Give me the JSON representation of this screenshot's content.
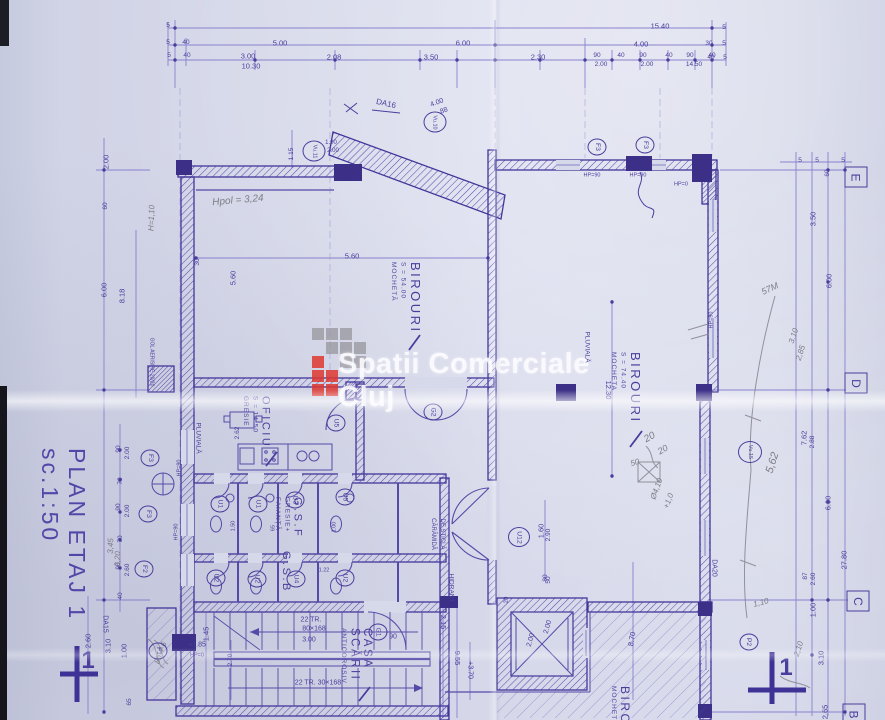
{
  "title": "PLAN ETAJ 1 sc.1:50",
  "watermark": {
    "text": "Spatii Comerciale Cluj",
    "logo_gray": "#97969c",
    "logo_red": "#dd372f"
  },
  "colors": {
    "ink": "#4a3d9c",
    "wall": "#43369a",
    "pencil": "#7e7c86",
    "paper": "#d6d9ea"
  },
  "grid_axis_labels": [
    {
      "t": "E",
      "x": 856,
      "y": 177
    },
    {
      "t": "D",
      "x": 856,
      "y": 383
    },
    {
      "t": "C",
      "x": 858,
      "y": 601
    },
    {
      "t": "B",
      "x": 854,
      "y": 714
    }
  ],
  "rooms": [
    {
      "name": "BIROURI",
      "subs": [
        "S = 54.00",
        "MOCHETĂ"
      ],
      "x": 388,
      "y": 262,
      "ns": 13
    },
    {
      "name": "BIROURI",
      "subs": [
        "S = 74.40",
        "MOCHETA"
      ],
      "x": 608,
      "y": 352,
      "ns": 13
    },
    {
      "name": "OFICIU",
      "subs": [
        "S = 14.50",
        "GRESIE"
      ],
      "x": 240,
      "y": 396,
      "ns": 11
    },
    {
      "name": "G.S.F",
      "subs": [
        "GRESIE+",
        "FAIANȚĂ"
      ],
      "x": 272,
      "y": 497,
      "ns": 11
    },
    {
      "name": "G.S.B",
      "subs": [],
      "x": 280,
      "y": 551,
      "ns": 11
    },
    {
      "name": "CASA SCĂRII",
      "subs": [
        "ANTICOROSIV"
      ],
      "x": 338,
      "y": 628,
      "ns": 11.5
    },
    {
      "name": "BIROURI",
      "subs": [
        "MOCHETĂ"
      ],
      "x": 608,
      "y": 686,
      "ns": 12
    }
  ],
  "circle_labels": [
    {
      "t": "F3",
      "x": 597,
      "y": 147
    },
    {
      "t": "F3",
      "x": 645,
      "y": 145
    },
    {
      "t": "Vu.10",
      "x": 435,
      "y": 122,
      "w": 21
    },
    {
      "t": "Vu.11",
      "x": 314,
      "y": 151,
      "w": 21
    },
    {
      "t": "G2",
      "x": 433,
      "y": 412
    },
    {
      "t": "U5",
      "x": 336,
      "y": 423
    },
    {
      "t": "U1",
      "x": 220,
      "y": 504
    },
    {
      "t": "U1",
      "x": 258,
      "y": 504
    },
    {
      "t": "U3",
      "x": 295,
      "y": 500
    },
    {
      "t": "U5",
      "x": 345,
      "y": 497
    },
    {
      "t": "U2",
      "x": 216,
      "y": 578
    },
    {
      "t": "U2",
      "x": 257,
      "y": 579
    },
    {
      "t": "U4",
      "x": 296,
      "y": 579
    },
    {
      "t": "U2",
      "x": 345,
      "y": 578
    },
    {
      "t": "U12",
      "x": 519,
      "y": 537,
      "w": 20
    },
    {
      "t": "F3",
      "x": 150,
      "y": 458
    },
    {
      "t": "F3",
      "x": 148,
      "y": 514
    },
    {
      "t": "F2",
      "x": 144,
      "y": 569
    },
    {
      "t": "F1",
      "x": 158,
      "y": 651
    },
    {
      "t": "G1",
      "x": 378,
      "y": 632
    },
    {
      "t": "P2",
      "x": 749,
      "y": 642
    },
    {
      "t": "Vu.15",
      "x": 750,
      "y": 452,
      "w": 22
    }
  ],
  "texts": [
    {
      "t": "15.40",
      "x": 660,
      "y": 26
    },
    {
      "t": "5.00",
      "x": 280,
      "y": 43
    },
    {
      "t": "6.00",
      "x": 463,
      "y": 43
    },
    {
      "t": "4.00",
      "x": 641,
      "y": 44
    },
    {
      "t": "3.00",
      "x": 248,
      "y": 56
    },
    {
      "t": "10.30",
      "x": 251,
      "y": 66
    },
    {
      "t": "2.08",
      "x": 334,
      "y": 57
    },
    {
      "t": "3.50",
      "x": 431,
      "y": 57
    },
    {
      "t": "2.30",
      "x": 538,
      "y": 57
    },
    {
      "t": "90",
      "x": 597,
      "y": 56,
      "s": 6.5
    },
    {
      "t": "2.00",
      "x": 601,
      "y": 65,
      "s": 6.5
    },
    {
      "t": "40",
      "x": 621,
      "y": 56,
      "s": 6.5
    },
    {
      "t": "90",
      "x": 643,
      "y": 56,
      "s": 6.5
    },
    {
      "t": "2.00",
      "x": 647,
      "y": 65,
      "s": 6.5
    },
    {
      "t": "40",
      "x": 669,
      "y": 56,
      "s": 6.5
    },
    {
      "t": "90",
      "x": 690,
      "y": 56,
      "s": 6.5
    },
    {
      "t": "14.50",
      "x": 694,
      "y": 65,
      "s": 6.5
    },
    {
      "t": "40",
      "x": 712,
      "y": 56,
      "s": 6.5
    },
    {
      "t": "5",
      "x": 168,
      "y": 26,
      "s": 6.5
    },
    {
      "t": "5",
      "x": 168,
      "y": 43,
      "s": 6.5
    },
    {
      "t": "40",
      "x": 186,
      "y": 43,
      "s": 6.5
    },
    {
      "t": "5",
      "x": 169,
      "y": 56,
      "s": 6.5
    },
    {
      "t": "40",
      "x": 187,
      "y": 56,
      "s": 6.5
    },
    {
      "t": "5",
      "x": 724,
      "y": 28,
      "s": 6.5
    },
    {
      "t": "30",
      "x": 709,
      "y": 44,
      "s": 6.5
    },
    {
      "t": "5",
      "x": 724,
      "y": 44,
      "s": 6.5
    },
    {
      "t": "40",
      "x": 711,
      "y": 58,
      "s": 6.5
    },
    {
      "t": "5",
      "x": 725,
      "y": 58,
      "s": 6.5
    },
    {
      "t": "2.00",
      "x": 106,
      "y": 162,
      "r": -90
    },
    {
      "t": "60",
      "x": 106,
      "y": 206,
      "r": -90,
      "s": 6.5
    },
    {
      "t": "6.00",
      "x": 104,
      "y": 290,
      "r": -90
    },
    {
      "t": "8.18",
      "x": 122,
      "y": 296,
      "r": -90
    },
    {
      "t": "5.60",
      "x": 233,
      "y": 278,
      "r": -90
    },
    {
      "t": "30",
      "x": 198,
      "y": 262,
      "r": -90,
      "s": 6.5
    },
    {
      "t": "90",
      "x": 119,
      "y": 449,
      "r": -90,
      "s": 6.5
    },
    {
      "t": "2.00",
      "x": 128,
      "y": 453,
      "r": -90,
      "s": 6.5
    },
    {
      "t": "70",
      "x": 121,
      "y": 481,
      "r": -90,
      "s": 6.5
    },
    {
      "t": "90",
      "x": 119,
      "y": 507,
      "r": -90,
      "s": 6.5
    },
    {
      "t": "2.00",
      "x": 128,
      "y": 511,
      "r": -90,
      "s": 6.5
    },
    {
      "t": "70",
      "x": 121,
      "y": 539,
      "r": -90,
      "s": 6.5
    },
    {
      "t": "90",
      "x": 119,
      "y": 566,
      "r": -90,
      "s": 6.5
    },
    {
      "t": "2.60",
      "x": 128,
      "y": 570,
      "r": -90,
      "s": 6.5
    },
    {
      "t": "40",
      "x": 121,
      "y": 596,
      "r": -90,
      "s": 6.5
    },
    {
      "t": "2.60",
      "x": 88,
      "y": 641,
      "r": -90
    },
    {
      "t": "3.10",
      "x": 108,
      "y": 646,
      "r": -90
    },
    {
      "t": "1.00",
      "x": 124,
      "y": 651,
      "r": -90
    },
    {
      "t": "65",
      "x": 130,
      "y": 702,
      "r": -90,
      "s": 6.5
    },
    {
      "t": "1.45",
      "x": 206,
      "y": 634,
      "r": -90
    },
    {
      "t": "2.70",
      "x": 231,
      "y": 660,
      "r": -90,
      "s": 6.5
    },
    {
      "t": "2.62",
      "x": 238,
      "y": 433,
      "r": -90,
      "s": 6.5
    },
    {
      "t": "1.15",
      "x": 292,
      "y": 154,
      "r": -90,
      "s": 6.5
    },
    {
      "t": "60",
      "x": 828,
      "y": 173,
      "r": -90,
      "s": 6.5
    },
    {
      "t": "3.50",
      "x": 813,
      "y": 219,
      "r": -90
    },
    {
      "t": "6.00",
      "x": 829,
      "y": 281,
      "r": -90
    },
    {
      "t": "7.62",
      "x": 804,
      "y": 438,
      "r": -90
    },
    {
      "t": "2.88",
      "x": 813,
      "y": 442,
      "r": -90,
      "s": 6.5
    },
    {
      "t": "6.00",
      "x": 828,
      "y": 503,
      "r": -90
    },
    {
      "t": "27.80",
      "x": 844,
      "y": 560,
      "r": -90
    },
    {
      "t": "87",
      "x": 806,
      "y": 576,
      "r": -90,
      "s": 6.5
    },
    {
      "t": "2.60",
      "x": 814,
      "y": 579,
      "r": -90,
      "s": 6.5
    },
    {
      "t": "1.00",
      "x": 813,
      "y": 610,
      "r": -90
    },
    {
      "t": "3.10",
      "x": 821,
      "y": 658,
      "r": -90
    },
    {
      "t": "2.65",
      "x": 825,
      "y": 712,
      "r": -90
    },
    {
      "t": "5",
      "x": 800,
      "y": 161,
      "s": 6.5
    },
    {
      "t": "5",
      "x": 817,
      "y": 161,
      "s": 6.5
    },
    {
      "t": "5",
      "x": 843,
      "y": 161,
      "s": 6.5
    },
    {
      "t": "5.60",
      "x": 352,
      "y": 256
    },
    {
      "t": "12.30",
      "x": 608,
      "y": 390,
      "r": 90
    },
    {
      "t": "8.70",
      "x": 632,
      "y": 639,
      "r": -80
    },
    {
      "t": "1.60",
      "x": 541,
      "y": 531,
      "r": -90
    },
    {
      "t": "2.90",
      "x": 549,
      "y": 535,
      "r": -90,
      "s": 6.5
    },
    {
      "t": "80",
      "x": 546,
      "y": 578,
      "r": -90,
      "s": 6.5
    },
    {
      "t": "2.15",
      "x": 443,
      "y": 622,
      "r": 90
    },
    {
      "t": "9.55",
      "x": 457,
      "y": 658,
      "r": 90
    },
    {
      "t": "+3.70",
      "x": 470,
      "y": 670,
      "r": 90,
      "s": 7
    },
    {
      "t": "1.00",
      "x": 331,
      "y": 143,
      "s": 6
    },
    {
      "t": "2.00",
      "x": 333,
      "y": 151,
      "s": 6
    },
    {
      "t": "4.00",
      "x": 437,
      "y": 103,
      "r": -20,
      "s": 7
    },
    {
      "t": "88",
      "x": 444,
      "y": 111,
      "r": -20,
      "s": 7
    },
    {
      "t": "DA16",
      "x": 386,
      "y": 104,
      "r": 13,
      "s": 8
    },
    {
      "t": "3.00",
      "x": 309,
      "y": 640,
      "s": 7
    },
    {
      "t": "90",
      "x": 393,
      "y": 637,
      "s": 7
    },
    {
      "t": "22 TR.",
      "x": 311,
      "y": 620,
      "s": 7
    },
    {
      "t": "80×168",
      "x": 314,
      "y": 629,
      "s": 7
    },
    {
      "t": "22 TR. 30×168",
      "x": 318,
      "y": 683,
      "s": 7
    },
    {
      "t": "2.00",
      "x": 548,
      "y": 627,
      "r": -75,
      "s": 7
    },
    {
      "t": "2.00",
      "x": 531,
      "y": 640,
      "r": -75,
      "s": 7
    },
    {
      "t": "50",
      "x": 549,
      "y": 580,
      "r": -90,
      "s": 6.5
    },
    {
      "t": "20",
      "x": 507,
      "y": 600,
      "r": -90,
      "s": 6
    },
    {
      "t": "HP=90",
      "x": 592,
      "y": 176,
      "s": 5.5
    },
    {
      "t": "HP=90",
      "x": 638,
      "y": 176,
      "s": 5.5
    },
    {
      "t": "HP=0",
      "x": 681,
      "y": 185,
      "s": 5.5
    },
    {
      "t": "HP=90",
      "x": 180,
      "y": 468,
      "r": -90,
      "s": 5.5
    },
    {
      "t": "HP=90",
      "x": 177,
      "y": 532,
      "r": -90,
      "s": 5.5
    },
    {
      "t": "HP=90",
      "x": 712,
      "y": 320,
      "r": -90,
      "s": 5.5
    },
    {
      "t": "+1.85",
      "x": 197,
      "y": 645,
      "s": 7
    },
    {
      "t": "HP=0",
      "x": 197,
      "y": 656,
      "s": 5.5
    },
    {
      "t": "1.50",
      "x": 234,
      "y": 526,
      "r": -90,
      "s": 5.5
    },
    {
      "t": "65",
      "x": 274,
      "y": 528,
      "r": -90,
      "s": 5.5
    },
    {
      "t": "1.00",
      "x": 335,
      "y": 527,
      "r": -90,
      "s": 5.5
    },
    {
      "t": "1.22",
      "x": 324,
      "y": 571,
      "s": 5.5
    },
    {
      "t": "PLUVIALĂ",
      "x": 197,
      "y": 438,
      "r": 90,
      "s": 6.5
    },
    {
      "t": "PLUVIALĂ",
      "x": 586,
      "y": 347,
      "r": 90,
      "s": 6.5
    },
    {
      "t": "HIDRANT",
      "x": 450,
      "y": 588,
      "r": 90,
      "s": 6.5
    },
    {
      "t": "CĂRĂMIDĂ",
      "x": 433,
      "y": 534,
      "r": 90,
      "s": 6
    },
    {
      "t": "DE STICLĂ",
      "x": 442,
      "y": 534,
      "r": 90,
      "s": 6
    },
    {
      "t": "GOL AERISIRE 20/20",
      "x": 151,
      "y": 362,
      "r": 90,
      "s": 5
    },
    {
      "t": "DA15",
      "x": 105,
      "y": 624,
      "r": 90,
      "s": 7
    },
    {
      "t": "DA20",
      "x": 714,
      "y": 568,
      "r": 90,
      "s": 7
    },
    {
      "t": "1",
      "x": 88,
      "y": 661,
      "s": 24,
      "b": 1,
      "n": "section-marker-number"
    },
    {
      "t": "1",
      "x": 786,
      "y": 668,
      "s": 24,
      "b": 1,
      "n": "section-marker-number"
    },
    {
      "t": "Hpol = 3,24",
      "x": 238,
      "y": 201,
      "r": -5,
      "s": 10,
      "c": "pencil"
    },
    {
      "t": "H=1,10",
      "x": 152,
      "y": 218,
      "r": -88,
      "s": 8,
      "c": "pencil"
    },
    {
      "t": "57M",
      "x": 770,
      "y": 289,
      "r": -25,
      "s": 9,
      "c": "pencil"
    },
    {
      "t": "3,10",
      "x": 794,
      "y": 336,
      "r": -72,
      "s": 8,
      "c": "pencil"
    },
    {
      "t": "2,85",
      "x": 801,
      "y": 353,
      "r": -72,
      "s": 8,
      "c": "pencil"
    },
    {
      "t": "5,62",
      "x": 773,
      "y": 463,
      "r": -72,
      "s": 11,
      "c": "pencil"
    },
    {
      "t": "20",
      "x": 650,
      "y": 438,
      "r": -30,
      "s": 10,
      "c": "pencil"
    },
    {
      "t": "20",
      "x": 663,
      "y": 450,
      "r": -30,
      "s": 9,
      "c": "pencil"
    },
    {
      "t": "50",
      "x": 635,
      "y": 463,
      "r": -15,
      "s": 8,
      "c": "pencil"
    },
    {
      "t": "Ø4,10",
      "x": 657,
      "y": 489,
      "r": -70,
      "s": 8,
      "c": "pencil"
    },
    {
      "t": "+1,0",
      "x": 669,
      "y": 501,
      "r": -70,
      "s": 8,
      "c": "pencil"
    },
    {
      "t": "1,10",
      "x": 761,
      "y": 603,
      "r": -15,
      "s": 8,
      "c": "pencil"
    },
    {
      "t": "2,10",
      "x": 799,
      "y": 649,
      "r": -72,
      "s": 8,
      "c": "pencil"
    },
    {
      "t": "8h 4-6",
      "x": 161,
      "y": 653,
      "r": -70,
      "s": 8,
      "c": "pencil"
    },
    {
      "t": "3,45",
      "x": 111,
      "y": 546,
      "r": -88,
      "s": 8,
      "c": "pencil"
    },
    {
      "t": "2,20",
      "x": 118,
      "y": 559,
      "r": -88,
      "s": 8,
      "c": "pencil"
    }
  ]
}
